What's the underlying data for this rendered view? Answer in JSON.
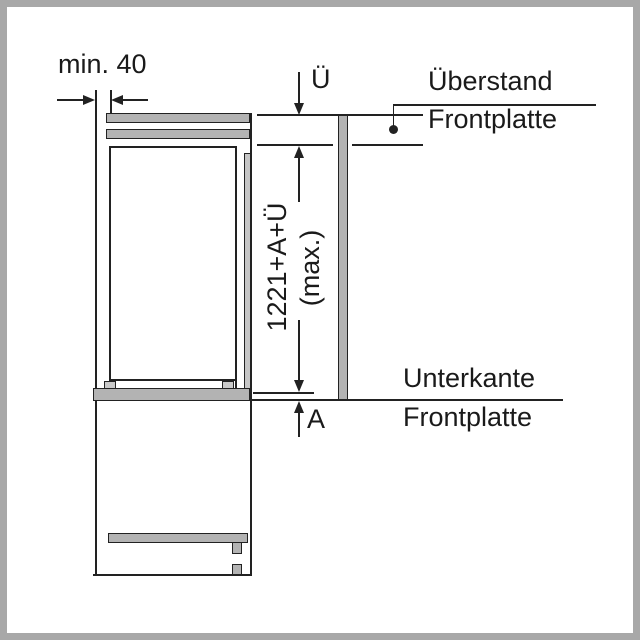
{
  "diagram": {
    "top_left": {
      "min_gap_label": "min. 40"
    },
    "top_right": {
      "overhang_symbol": "Ü",
      "callout_line1": "Überstand",
      "callout_line2": "Frontplatte"
    },
    "center": {
      "length_label": "1221+A+Ü",
      "length_qualifier": "(max.)"
    },
    "bottom_right": {
      "offset_symbol": "A",
      "callout_line1": "Unterkante",
      "callout_line2": "Frontplatte"
    },
    "colors": {
      "line": "#222222",
      "fill_gray": "#b3b3b3",
      "fill_mid": "#c6c6c6",
      "fill_light": "#c9c9c9",
      "frame": "#a8a8a8",
      "background": "#ffffff",
      "text": "#1a1a1a"
    }
  }
}
